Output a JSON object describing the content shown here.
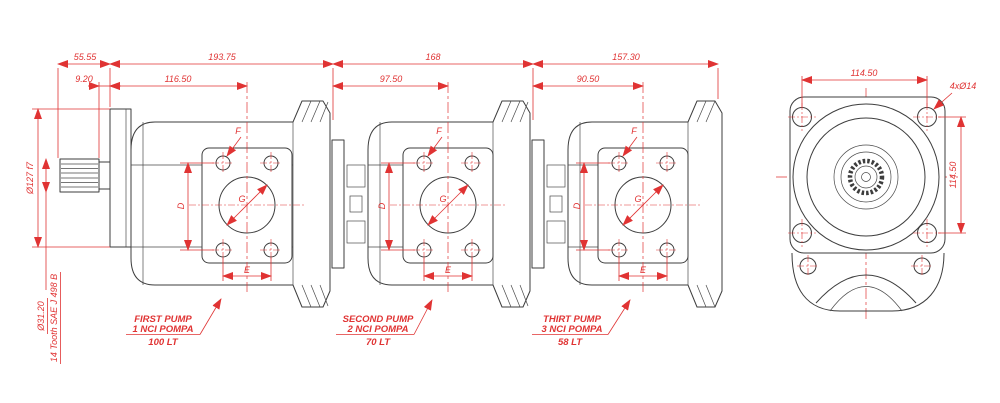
{
  "drawing": {
    "type": "engineering-drawing",
    "subject": "triple tandem gear pump, side view and rear flange view",
    "colors": {
      "line": "#3d3d3d",
      "dimension": "#e03333",
      "background": "#ffffff"
    }
  },
  "dims_top": {
    "d1": "55.55",
    "d2": "193.75",
    "d3": "168",
    "d4": "157.30"
  },
  "dims_row2": {
    "d1": "9.20",
    "d2": "116.50",
    "d3": "97.50",
    "d4": "90.50"
  },
  "left_labels": {
    "flange_dia": "Ø127 f7",
    "shaft_dia": "Ø31.20",
    "spline": "14 Tooth SAE J 498 B"
  },
  "port_labels": {
    "d": "D",
    "g": "G",
    "e": "E",
    "f": "F"
  },
  "pumps": [
    {
      "line1": "FIRST PUMP",
      "line2": "1 NCI POMPA",
      "capacity": "100 LT"
    },
    {
      "line1": "SECOND PUMP",
      "line2": "2 NCI POMPA",
      "capacity": "70 LT"
    },
    {
      "line1": "THIRT PUMP",
      "line2": "3 NCI POMPA",
      "capacity": "58 LT"
    }
  ],
  "end_view": {
    "bolt_spacing_h": "114.50",
    "bolt_spacing_v": "114.50",
    "holes": "4xØ14"
  }
}
